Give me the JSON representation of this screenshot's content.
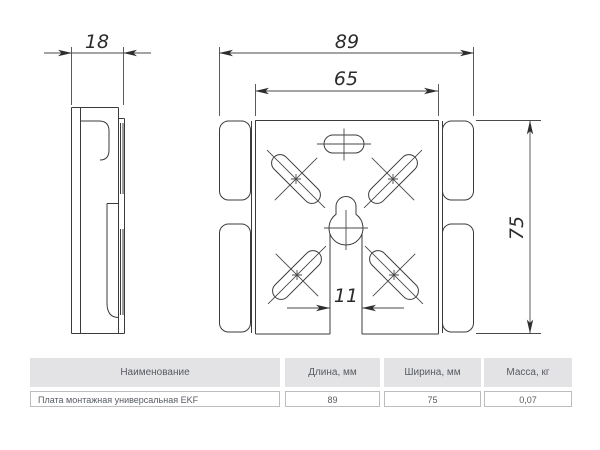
{
  "drawing": {
    "dim_side_width": "18",
    "dim_overall_width": "89",
    "dim_inner_width": "65",
    "dim_height": "75",
    "dim_slot_width": "11"
  },
  "table": {
    "headers": [
      "Наименование",
      "Длина, мм",
      "Ширина, мм",
      "Масса, кг"
    ],
    "rows": [
      [
        "Плата монтажная универсальная EKF",
        "89",
        "75",
        "0,07"
      ]
    ]
  },
  "colors": {
    "line": "#3b3b3d",
    "table_header_bg": "#e3e3e5",
    "table_text": "#565b63",
    "table_border": "#bdbdbf"
  }
}
